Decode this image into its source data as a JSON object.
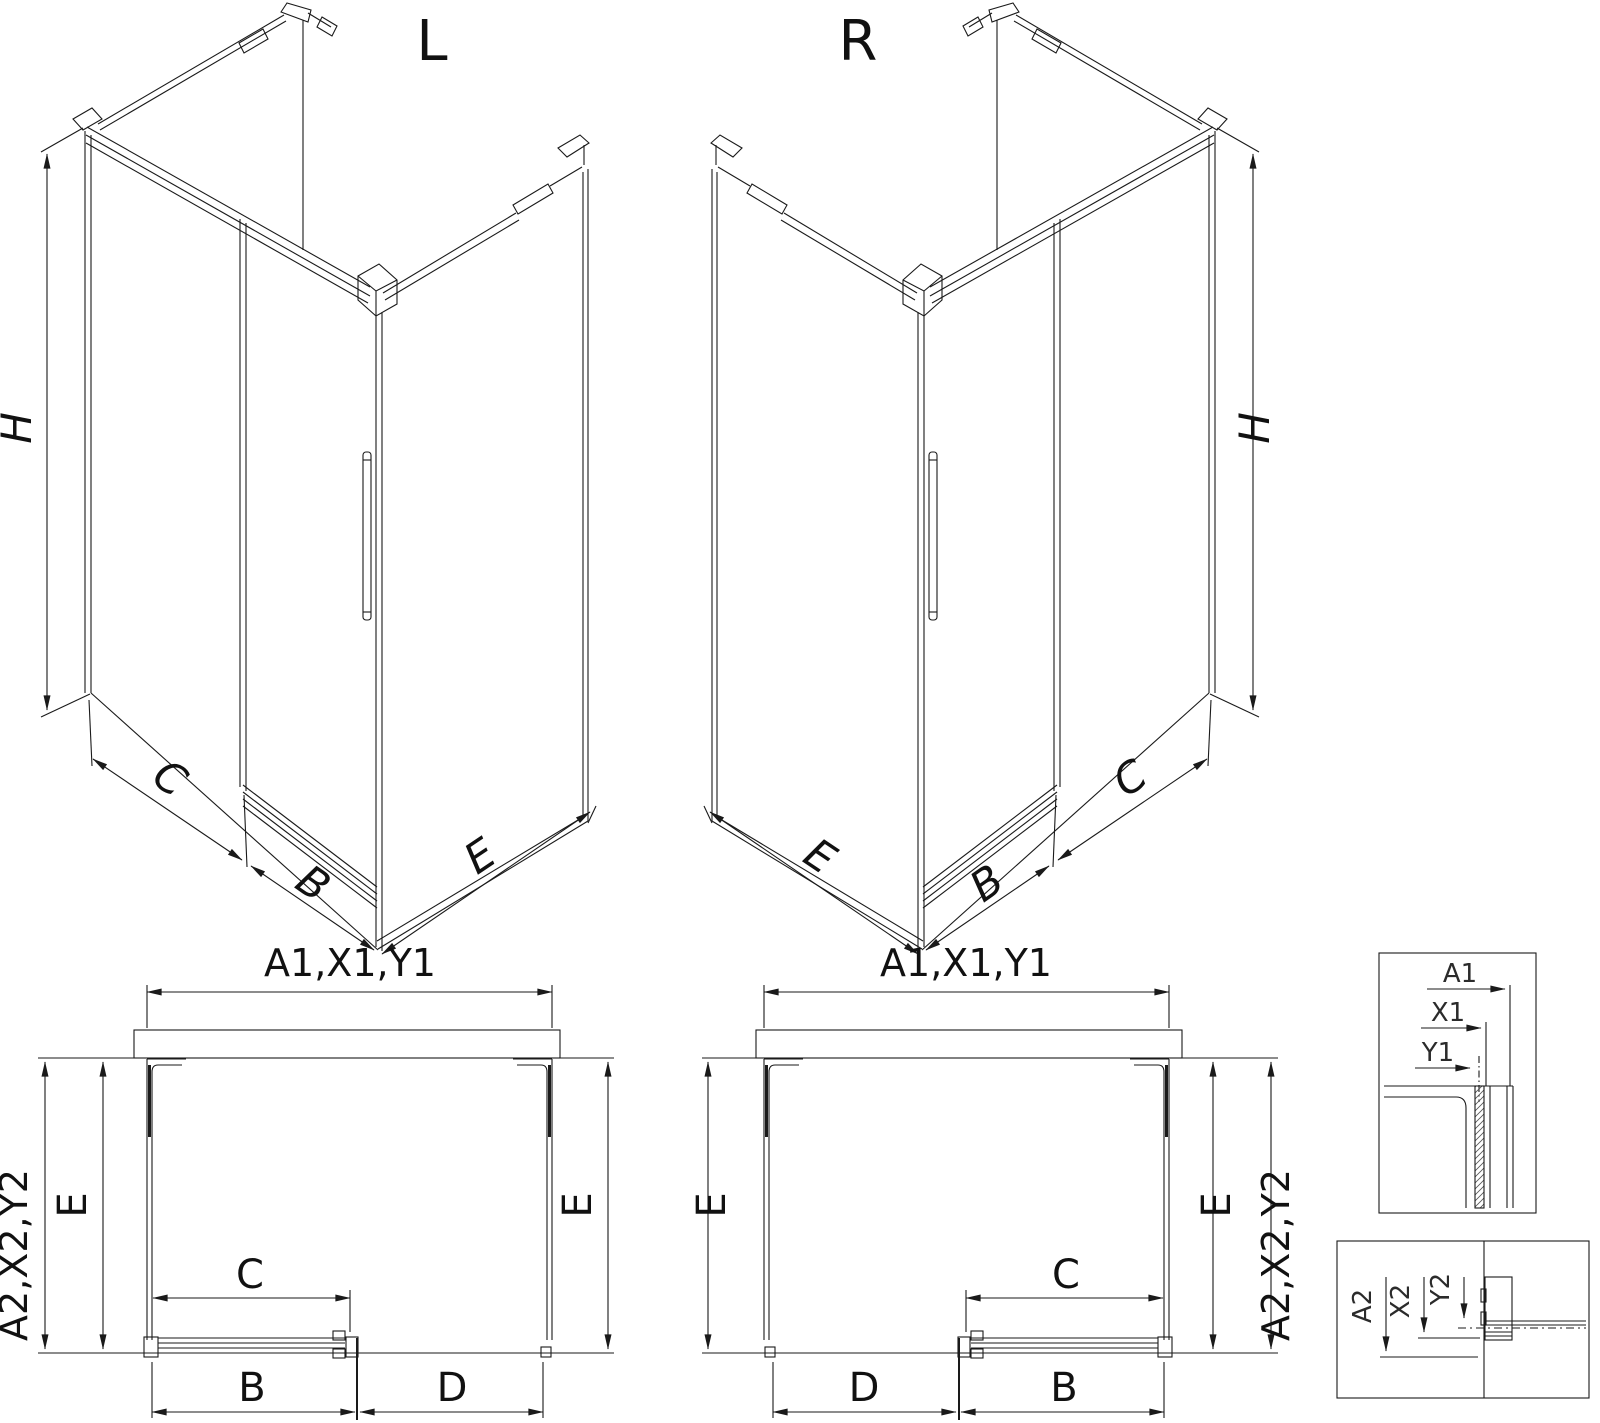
{
  "colors": {
    "line": "#1a1a1a",
    "background": "#ffffff"
  },
  "views": {
    "iso_left": {
      "title": "L",
      "h": "H",
      "c": "C",
      "b": "B",
      "e": "E"
    },
    "iso_right": {
      "title": "R",
      "h": "H",
      "c": "C",
      "b": "B",
      "e": "E"
    },
    "plan_left": {
      "width_top": "A1,X1,Y1",
      "depth_side": "A2,X2,Y2",
      "e_left": "E",
      "e_right": "E",
      "c": "C",
      "b": "B",
      "d": "D"
    },
    "plan_right": {
      "width_top": "A1,X1,Y1",
      "depth_side": "A2,X2,Y2",
      "e_left": "E",
      "e_right": "E",
      "c": "C",
      "b": "B",
      "d": "D"
    },
    "detail_width": {
      "a1": "A1",
      "x1": "X1",
      "y1": "Y1"
    },
    "detail_depth": {
      "a2": "A2",
      "x2": "X2",
      "y2": "Y2"
    }
  }
}
